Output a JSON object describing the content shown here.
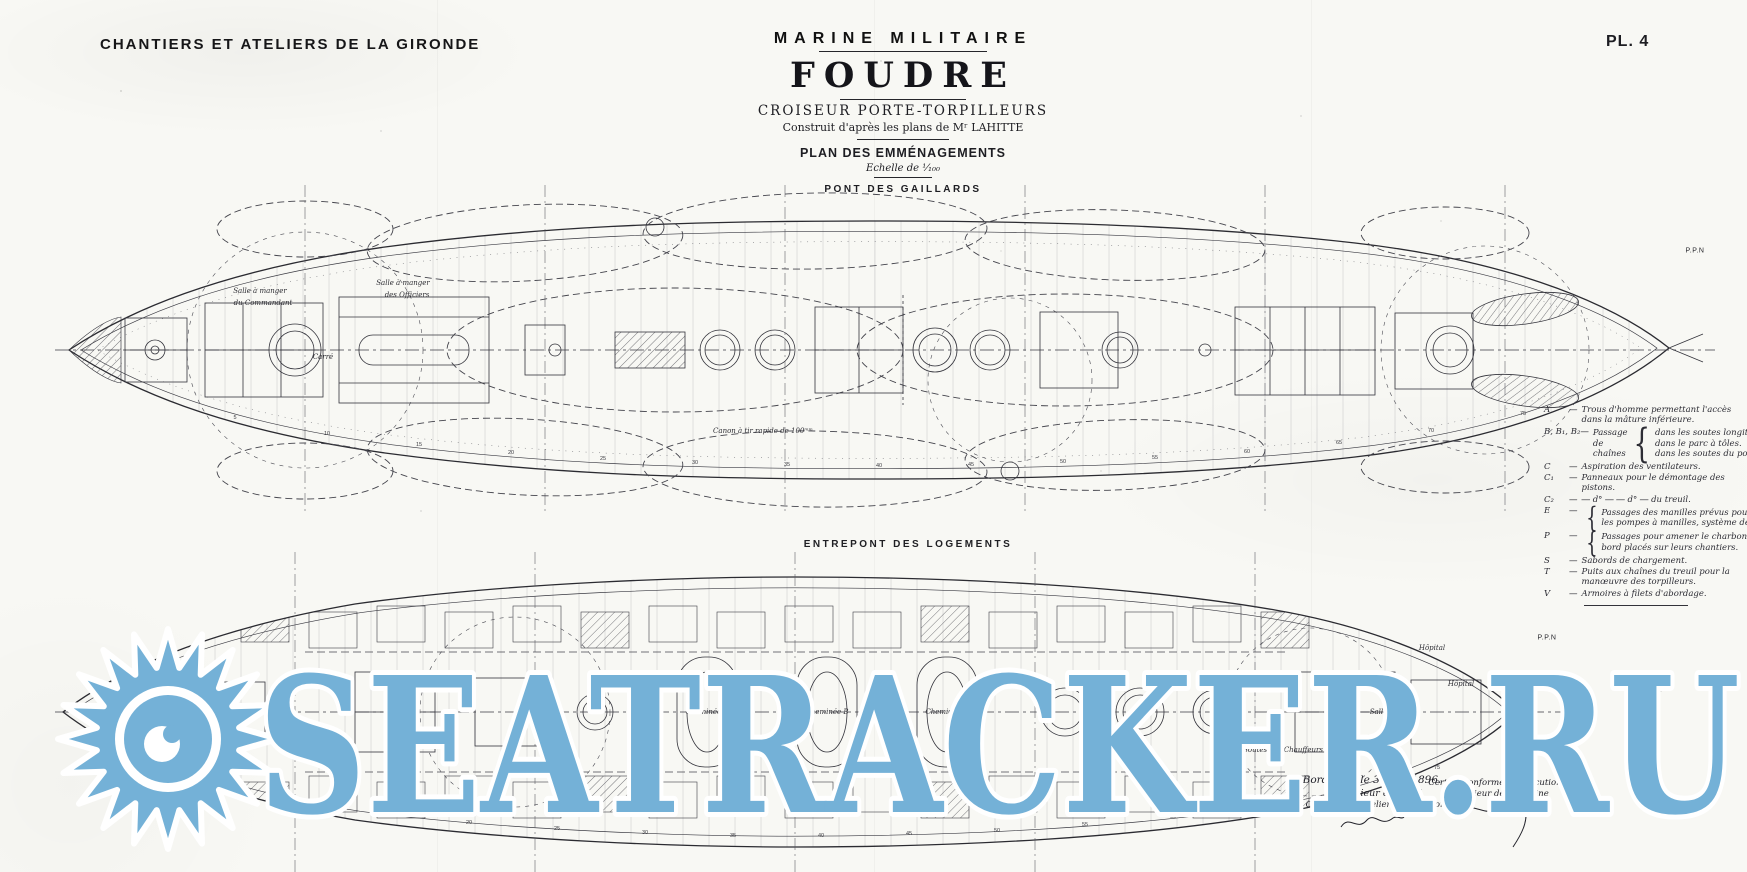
{
  "header": {
    "company": "CHANTIERS ET ATELIERS DE LA GIRONDE",
    "plate": "PL. 4"
  },
  "title_block": {
    "series": "MARINE MILITAIRE",
    "ship": "FOUDRE",
    "type": "CROISEUR PORTE-TORPILLEURS",
    "built": "Construit d'après les plans de Mʳ LAHITTE",
    "plan_name": "PLAN DES EMMÉNAGEMENTS",
    "scale": "Echelle de ¹⁄₁₀₀",
    "deck1_label": "PONT DES GAILLARDS"
  },
  "deck2_label": "ENTREPONT DES LOGEMENTS",
  "legend": {
    "items": [
      {
        "key": "A",
        "text": "Trous d'homme permettant l'accès dans la mâture inférieure."
      },
      {
        "key": "B, B₁, B₂",
        "text": "Passage de chaînes",
        "sub": [
          "dans les soutes longitudinales de la cale.",
          "dans le parc à tôles.",
          "dans les soutes du pont cellulaire."
        ]
      },
      {
        "key": "C",
        "text": "Aspiration des ventilateurs."
      },
      {
        "key": "C₁",
        "text": "Panneaux pour le démontage des pistons."
      },
      {
        "key": "C₂",
        "text": "― d° ―  ― d° ―  du treuil."
      },
      {
        "key": "E",
        "sub": [
          "Passages des manilles prévus pour remplacer en cas de besoin",
          "les pompes à manilles, système de Mompeau."
        ]
      },
      {
        "key": "P",
        "sub": [
          "Passages pour amener le charbon spécial aux torpilleurs du",
          "bord placés sur leurs chantiers."
        ]
      },
      {
        "key": "S",
        "text": "Sabords de chargement."
      },
      {
        "key": "T",
        "text": "Puits aux chaînes du treuil pour la manœuvre des torpilleurs."
      },
      {
        "key": "V",
        "text": "Armoires à filets d'abordage."
      }
    ]
  },
  "upper_plan": {
    "annotations": [
      {
        "t": "Salle à manger",
        "x": 205,
        "y": 106
      },
      {
        "t": "du Commandant",
        "x": 208,
        "y": 118
      },
      {
        "t": "Salle à manger",
        "x": 348,
        "y": 98
      },
      {
        "t": "des Officiers",
        "x": 352,
        "y": 110
      },
      {
        "t": "Carré",
        "x": 268,
        "y": 172
      },
      {
        "t": "Canon à tir rapide de 100ᵐᵐ",
        "x": 708,
        "y": 246
      },
      {
        "t": "P.P.N",
        "x": 1640,
        "y": 66,
        "sans": true
      }
    ],
    "frame_numbers": [
      5,
      10,
      15,
      20,
      25,
      30,
      35,
      40,
      45,
      50,
      55,
      60,
      65,
      70,
      75
    ]
  },
  "lower_plan": {
    "annotations": [
      {
        "t": "Cheminée A",
        "x": 652,
        "y": 160
      },
      {
        "t": "Cheminée B",
        "x": 772,
        "y": 160
      },
      {
        "t": "Cheminée C",
        "x": 892,
        "y": 160
      },
      {
        "t": "Hôpital",
        "x": 1377,
        "y": 96
      },
      {
        "t": "Hôpital",
        "x": 1406,
        "y": 132
      },
      {
        "t": "Salle de Visite",
        "x": 1340,
        "y": 160
      },
      {
        "t": "Magasin général",
        "x": 1318,
        "y": 186
      },
      {
        "t": "Soutes des Chauffeurs",
        "x": 1228,
        "y": 198
      },
      {
        "t": "P.P.N",
        "x": 1492,
        "y": 86,
        "sans": true
      }
    ],
    "frame_numbers": [
      5,
      10,
      15,
      20,
      25,
      30,
      35,
      40,
      45,
      50,
      55,
      60,
      65,
      70,
      75
    ]
  },
  "signatures": {
    "left": [
      "Bordeaux, le 3 Avril 1896.",
      "L'Ingénieur en Chef",
      "des Chantiers et Ateliers de la Gironde"
    ],
    "right": [
      "Certifié conforme à l'exécution",
      "L'Ingénieur de la Marine"
    ]
  },
  "watermark": {
    "text": "SEATRACKER.RU",
    "color": "#74b1d7",
    "logo": "sunburst"
  }
}
